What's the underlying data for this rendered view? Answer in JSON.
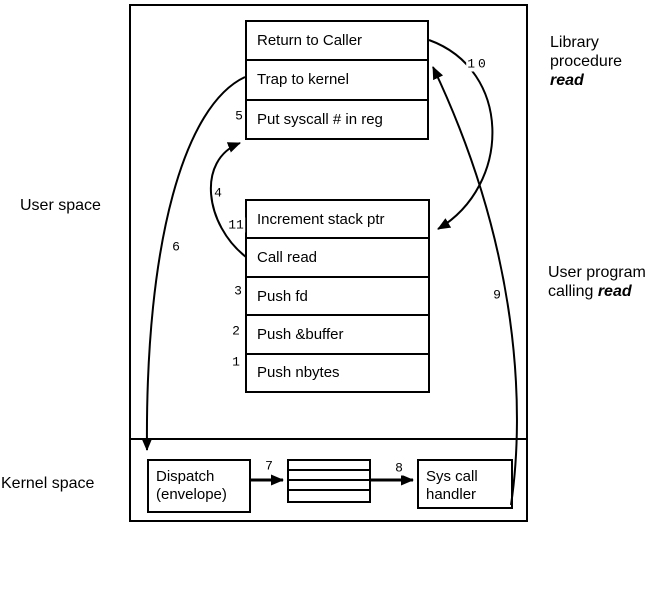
{
  "labels": {
    "user_space": "User space",
    "kernel_space": "Kernel space",
    "library_caption": {
      "line1": "Library",
      "line2": "procedure",
      "emphasis": "read"
    },
    "user_program_caption": {
      "line1": "User program",
      "line2_prefix": "calling",
      "emphasis": "read"
    }
  },
  "library_box": {
    "rows": [
      "Return to Caller",
      "Trap to kernel",
      "Put syscall # in reg"
    ]
  },
  "user_program_box": {
    "rows": [
      "Increment stack ptr",
      "Call read",
      "Push fd",
      "Push &buffer",
      "Push nbytes"
    ]
  },
  "kernel": {
    "dispatch_box": {
      "line1": "Dispatch",
      "line2": "(envelope)"
    },
    "handler_box": {
      "line1": "Sys call",
      "line2": "handler"
    }
  },
  "steps": [
    "1",
    "2",
    "3",
    "4",
    "5",
    "6",
    "7",
    "8",
    "9",
    "10",
    "11"
  ],
  "colors": {
    "line": "#000000",
    "background": "#ffffff",
    "text": "#000000"
  }
}
